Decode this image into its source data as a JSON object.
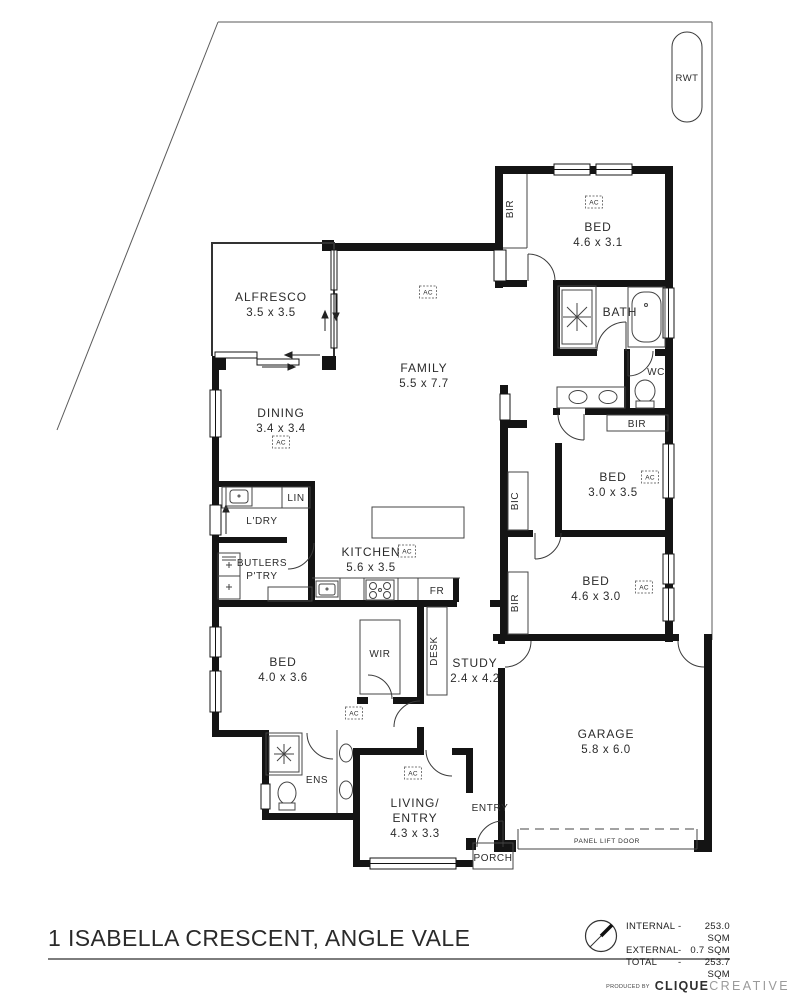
{
  "footer": {
    "title": "1 ISABELLA CRESCENT, ANGLE VALE",
    "producer_prefix": "PRODUCED BY",
    "producer_bold": "CLIQUE",
    "producer_light": "CREATIVE",
    "areas": [
      {
        "label": "INTERNAL",
        "dash": "-",
        "value": "253.0 SQM"
      },
      {
        "label": "EXTERNAL",
        "dash": "-",
        "value": "0.7 SQM"
      },
      {
        "label": "TOTAL",
        "dash": "-",
        "value": "253.7 SQM"
      }
    ]
  },
  "site": {
    "rwt": "RWT"
  },
  "rooms": {
    "alfresco": {
      "name": "ALFRESCO",
      "dims": "3.5 x 3.5"
    },
    "family": {
      "name": "FAMILY",
      "dims": "5.5 x 7.7"
    },
    "dining": {
      "name": "DINING",
      "dims": "3.4 x 3.4"
    },
    "kitchen": {
      "name": "KITCHEN",
      "dims": "5.6 x 3.5"
    },
    "bed1": {
      "name": "BED",
      "dims": "4.6 x 3.1"
    },
    "bed2": {
      "name": "BED",
      "dims": "3.0 x 3.5"
    },
    "bed3": {
      "name": "BED",
      "dims": "4.6 x 3.0"
    },
    "bed4": {
      "name": "BED",
      "dims": "4.0 x 3.6"
    },
    "garage": {
      "name": "GARAGE",
      "dims": "5.8 x 6.0"
    },
    "study": {
      "name": "STUDY",
      "dims": "2.4 x 4.2"
    },
    "living": {
      "line1": "LIVING/",
      "line2": "ENTRY",
      "dims": "4.3 x 3.3"
    },
    "bath": {
      "name": "BATH"
    },
    "wc": {
      "name": "WC"
    },
    "ens": {
      "name": "ENS"
    },
    "ldry": {
      "name": "L'DRY"
    },
    "butlers": {
      "line1": "BUTLERS",
      "line2": "P'TRY"
    },
    "wir": {
      "name": "WIR"
    },
    "entry": {
      "name": "ENTRY"
    },
    "porch": {
      "name": "PORCH"
    }
  },
  "labels": {
    "bir": "BIR",
    "bic": "BIC",
    "lin": "LIN",
    "fr": "FR",
    "desk": "DESK",
    "ac": "AC",
    "panel_lift_door": "PANEL LIFT DOOR"
  }
}
